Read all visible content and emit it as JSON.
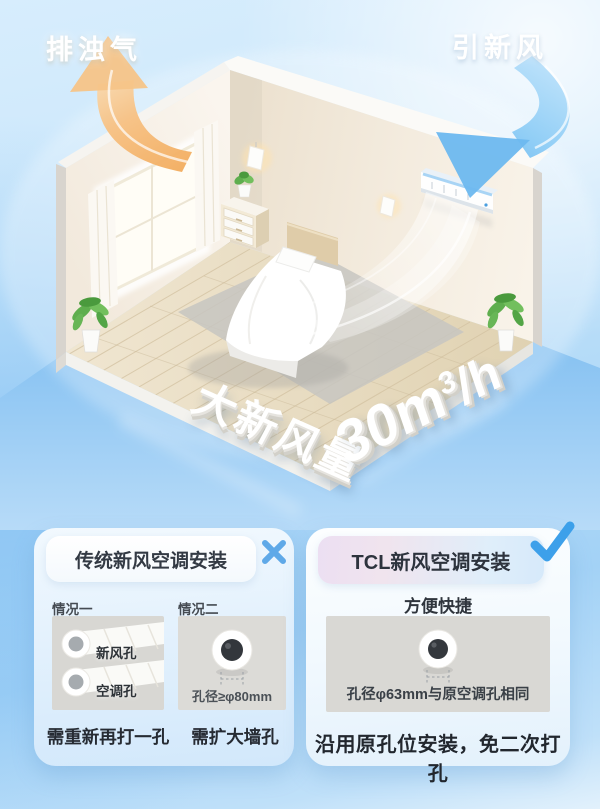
{
  "scene": {
    "exhaust_label": "排浊气",
    "fresh_air_label": "引新风",
    "volume_prefix": "大新风量",
    "volume_value": "30m",
    "volume_sup": "3",
    "volume_unit": "/h"
  },
  "comparison": {
    "traditional": {
      "title": "传统新风空调安装",
      "result": "rejected",
      "cases": [
        {
          "label": "情况一",
          "hole_labels": [
            "新风孔",
            "空调孔"
          ],
          "caption": "需重新再打一孔"
        },
        {
          "label": "情况二",
          "hole_note": "孔径≥φ80mm",
          "caption": "需扩大墙孔"
        }
      ]
    },
    "tcl": {
      "title": "TCL新风空调安装",
      "result": "approved",
      "subtitle": "方便快捷",
      "hole_note": "孔径φ63mm与原空调孔相同",
      "caption": "沿用原孔位安装，免二次打孔"
    }
  },
  "colors": {
    "accent_blue": "#4aa3e8",
    "arrow_orange": "#f3b264",
    "arrow_blue": "#7cc0f2",
    "sky_top": "#d5ecfc",
    "deep_blue": "#8ec7f3"
  }
}
